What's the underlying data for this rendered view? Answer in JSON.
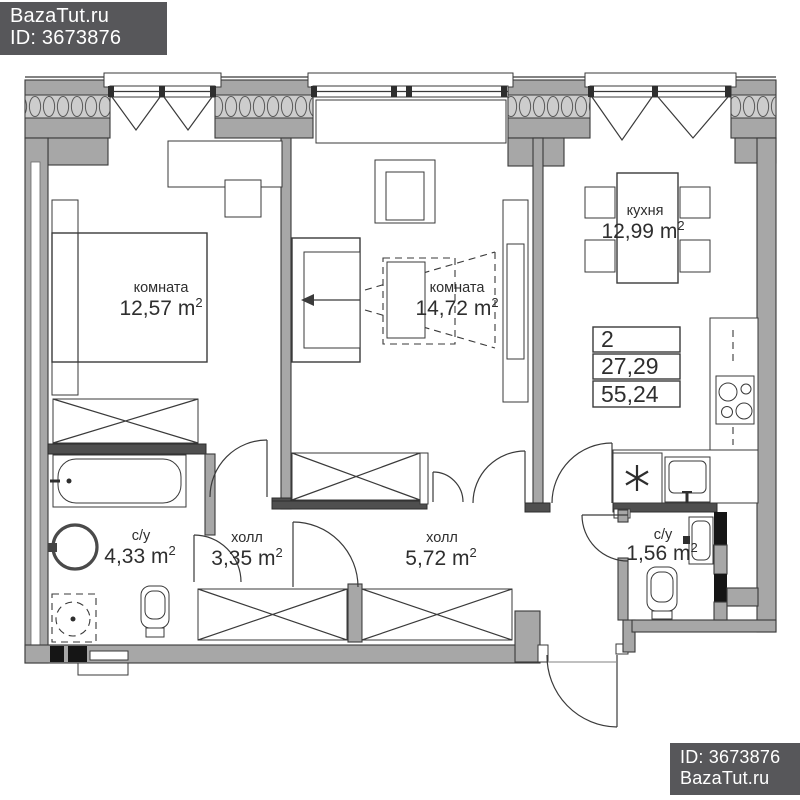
{
  "watermark_top": {
    "site": "BazaTut.ru",
    "id_label": "ID: 3673876"
  },
  "watermark_bottom": {
    "id_label": "ID: 3673876",
    "site": "BazaTut.ru"
  },
  "plan": {
    "type": "apartment-floor-plan",
    "rooms": [
      {
        "name": "комната",
        "area": "12,57 m",
        "area_sup": "2"
      },
      {
        "name": "комната",
        "area": "14,72 m",
        "area_sup": "2"
      },
      {
        "name": "кухня",
        "area": "12,99 m",
        "area_sup": "2"
      },
      {
        "name": "с/у",
        "area": "4,33 m",
        "area_sup": "2"
      },
      {
        "name": "холл",
        "area": "3,35 m",
        "area_sup": "2"
      },
      {
        "name": "холл",
        "area": "5,72 m",
        "area_sup": "2"
      },
      {
        "name": "с/у",
        "area": "1,56 m",
        "area_sup": "2"
      }
    ],
    "summary_table": {
      "rows": [
        "2",
        "27,29",
        "55,24"
      ]
    },
    "colors": {
      "wall": "#a7a7a7",
      "wall_dark": "#4f4f4f",
      "shaft_black": "#151515",
      "line": "#3a3a3a",
      "hatch_bg": "#cdcdcd",
      "badge_bg": "#57575a",
      "badge_text": "#ffffff",
      "background": "#ffffff"
    }
  }
}
